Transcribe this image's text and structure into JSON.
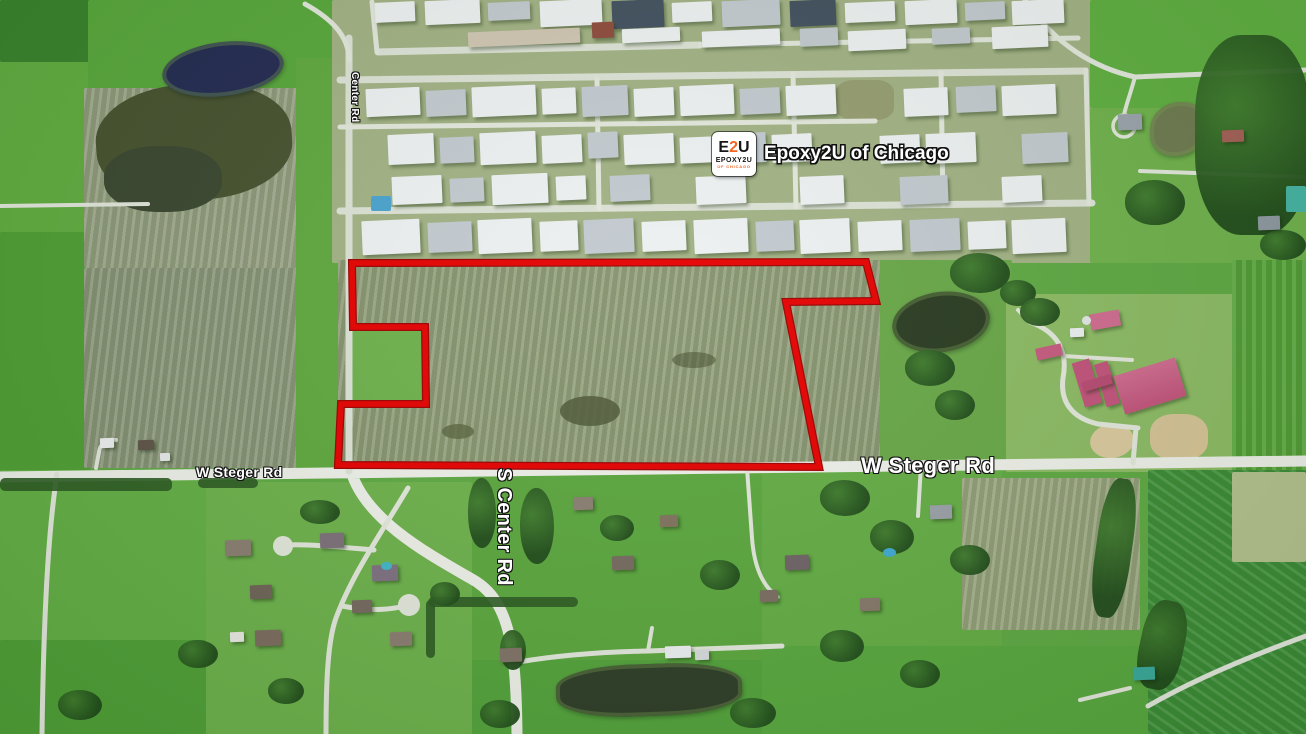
{
  "map": {
    "view": "satellite",
    "poi": {
      "label": "Epoxy2U of Chicago",
      "logo_e": "E",
      "logo_2": "2",
      "logo_u": "U",
      "logo_line2": "EPOXY2U",
      "logo_line3": "OF CHICAGO"
    },
    "road_labels": {
      "w_steger_rd_left": "W Steger Rd",
      "w_steger_rd_right": "W Steger Rd",
      "s_center_rd": "S Center Rd",
      "center_rd": "Center Rd"
    },
    "boundary": {
      "points": "352,263 866,262 876,301 786,302 819,467 338,465 341,404 426,404 425,327 353,327",
      "color": "#e60000"
    },
    "colors": {
      "boundary_red": "#e60000",
      "logo_accent_orange": "#f26522",
      "label_text": "#ffffff"
    }
  }
}
